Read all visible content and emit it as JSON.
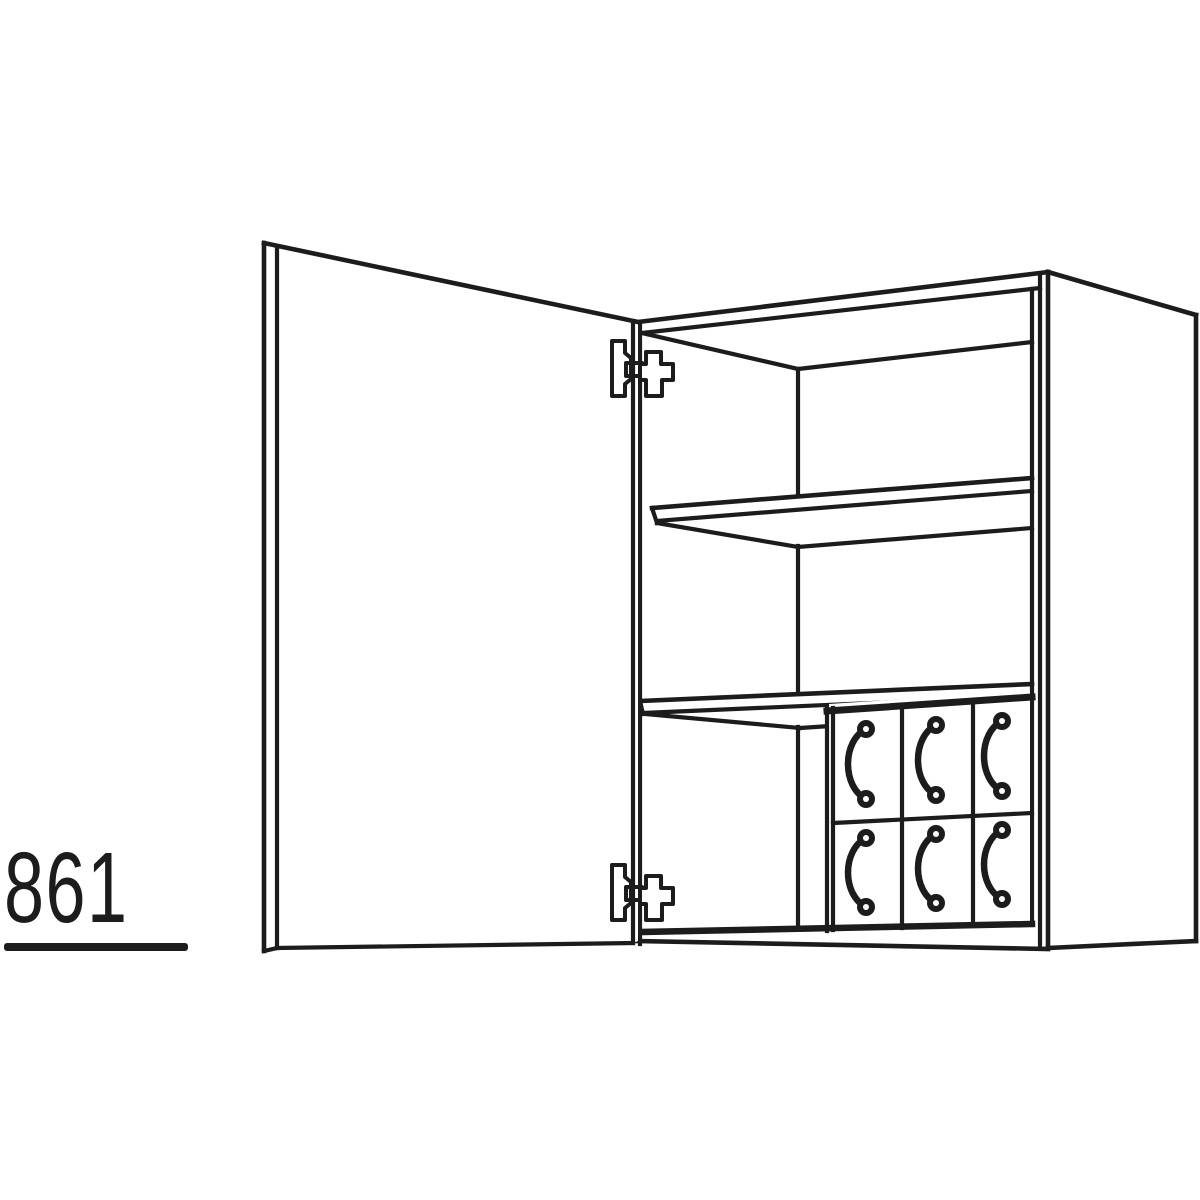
{
  "drawing": {
    "label": "861",
    "label_underlined": true,
    "line_color": "#1c1c1c",
    "background_color": "#ffffff",
    "subject": "wall cabinet technical line drawing: open left-hinged door, interior shelf, and internal drawer block",
    "components": {
      "door": {
        "state": "open",
        "hinge_count": 2
      },
      "shelf_count": 2,
      "drawer_block": {
        "columns": 3,
        "rows": 2,
        "handle_count": 6
      }
    }
  }
}
